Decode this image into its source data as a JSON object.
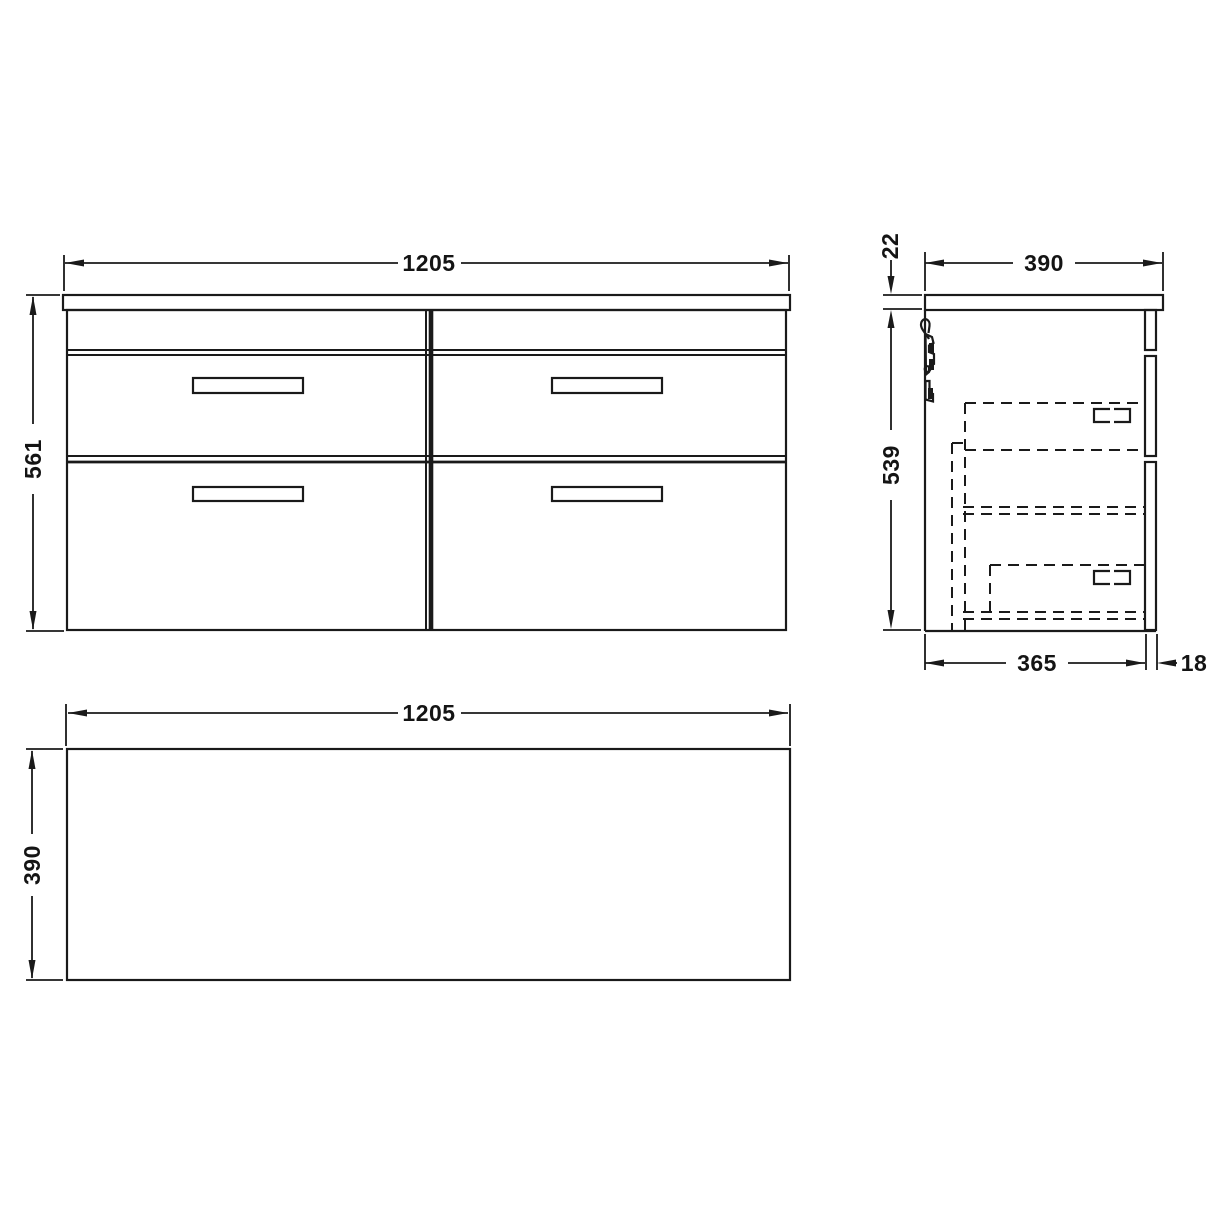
{
  "colors": {
    "ink": "#1a1a1a",
    "paper": "#ffffff"
  },
  "front_view": {
    "width_label": "1205",
    "height_label": "561"
  },
  "side_view": {
    "depth_label": "390",
    "worktop_thickness_label": "22",
    "carcass_height_label": "539",
    "carcass_depth_label": "365",
    "drawer_front_thickness_label": "18"
  },
  "plan_view": {
    "width_label": "1205",
    "depth_label": "390"
  }
}
